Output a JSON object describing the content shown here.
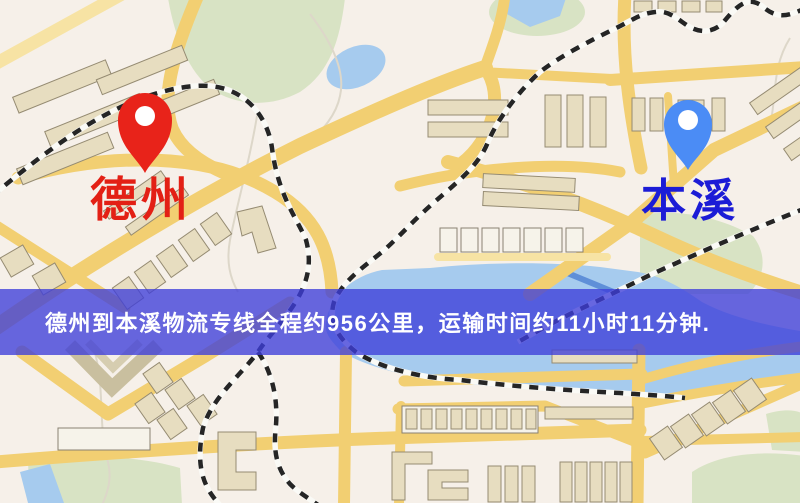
{
  "map": {
    "origin": {
      "label": "德州",
      "pin_color": "#e8231a",
      "label_color": "#e32015"
    },
    "destination": {
      "label": "本溪",
      "pin_color": "#4b8cf5",
      "label_color": "#1c1cd6"
    },
    "banner": {
      "text": "德州到本溪物流专线全程约956公里，运输时间约11小时11分钟.",
      "background_color": "#3e3eda",
      "text_color": "#ffffff"
    },
    "route": {
      "from": "德州",
      "to": "本溪",
      "distance_km": "956",
      "duration_hours": "11",
      "duration_minutes": "11"
    },
    "palette": {
      "land": "#f6f0e9",
      "road": "#f2cf72",
      "building": "#e7ddc0",
      "park": "#d8e3c4",
      "water": "#a6cbee",
      "railway": "#252525"
    }
  }
}
